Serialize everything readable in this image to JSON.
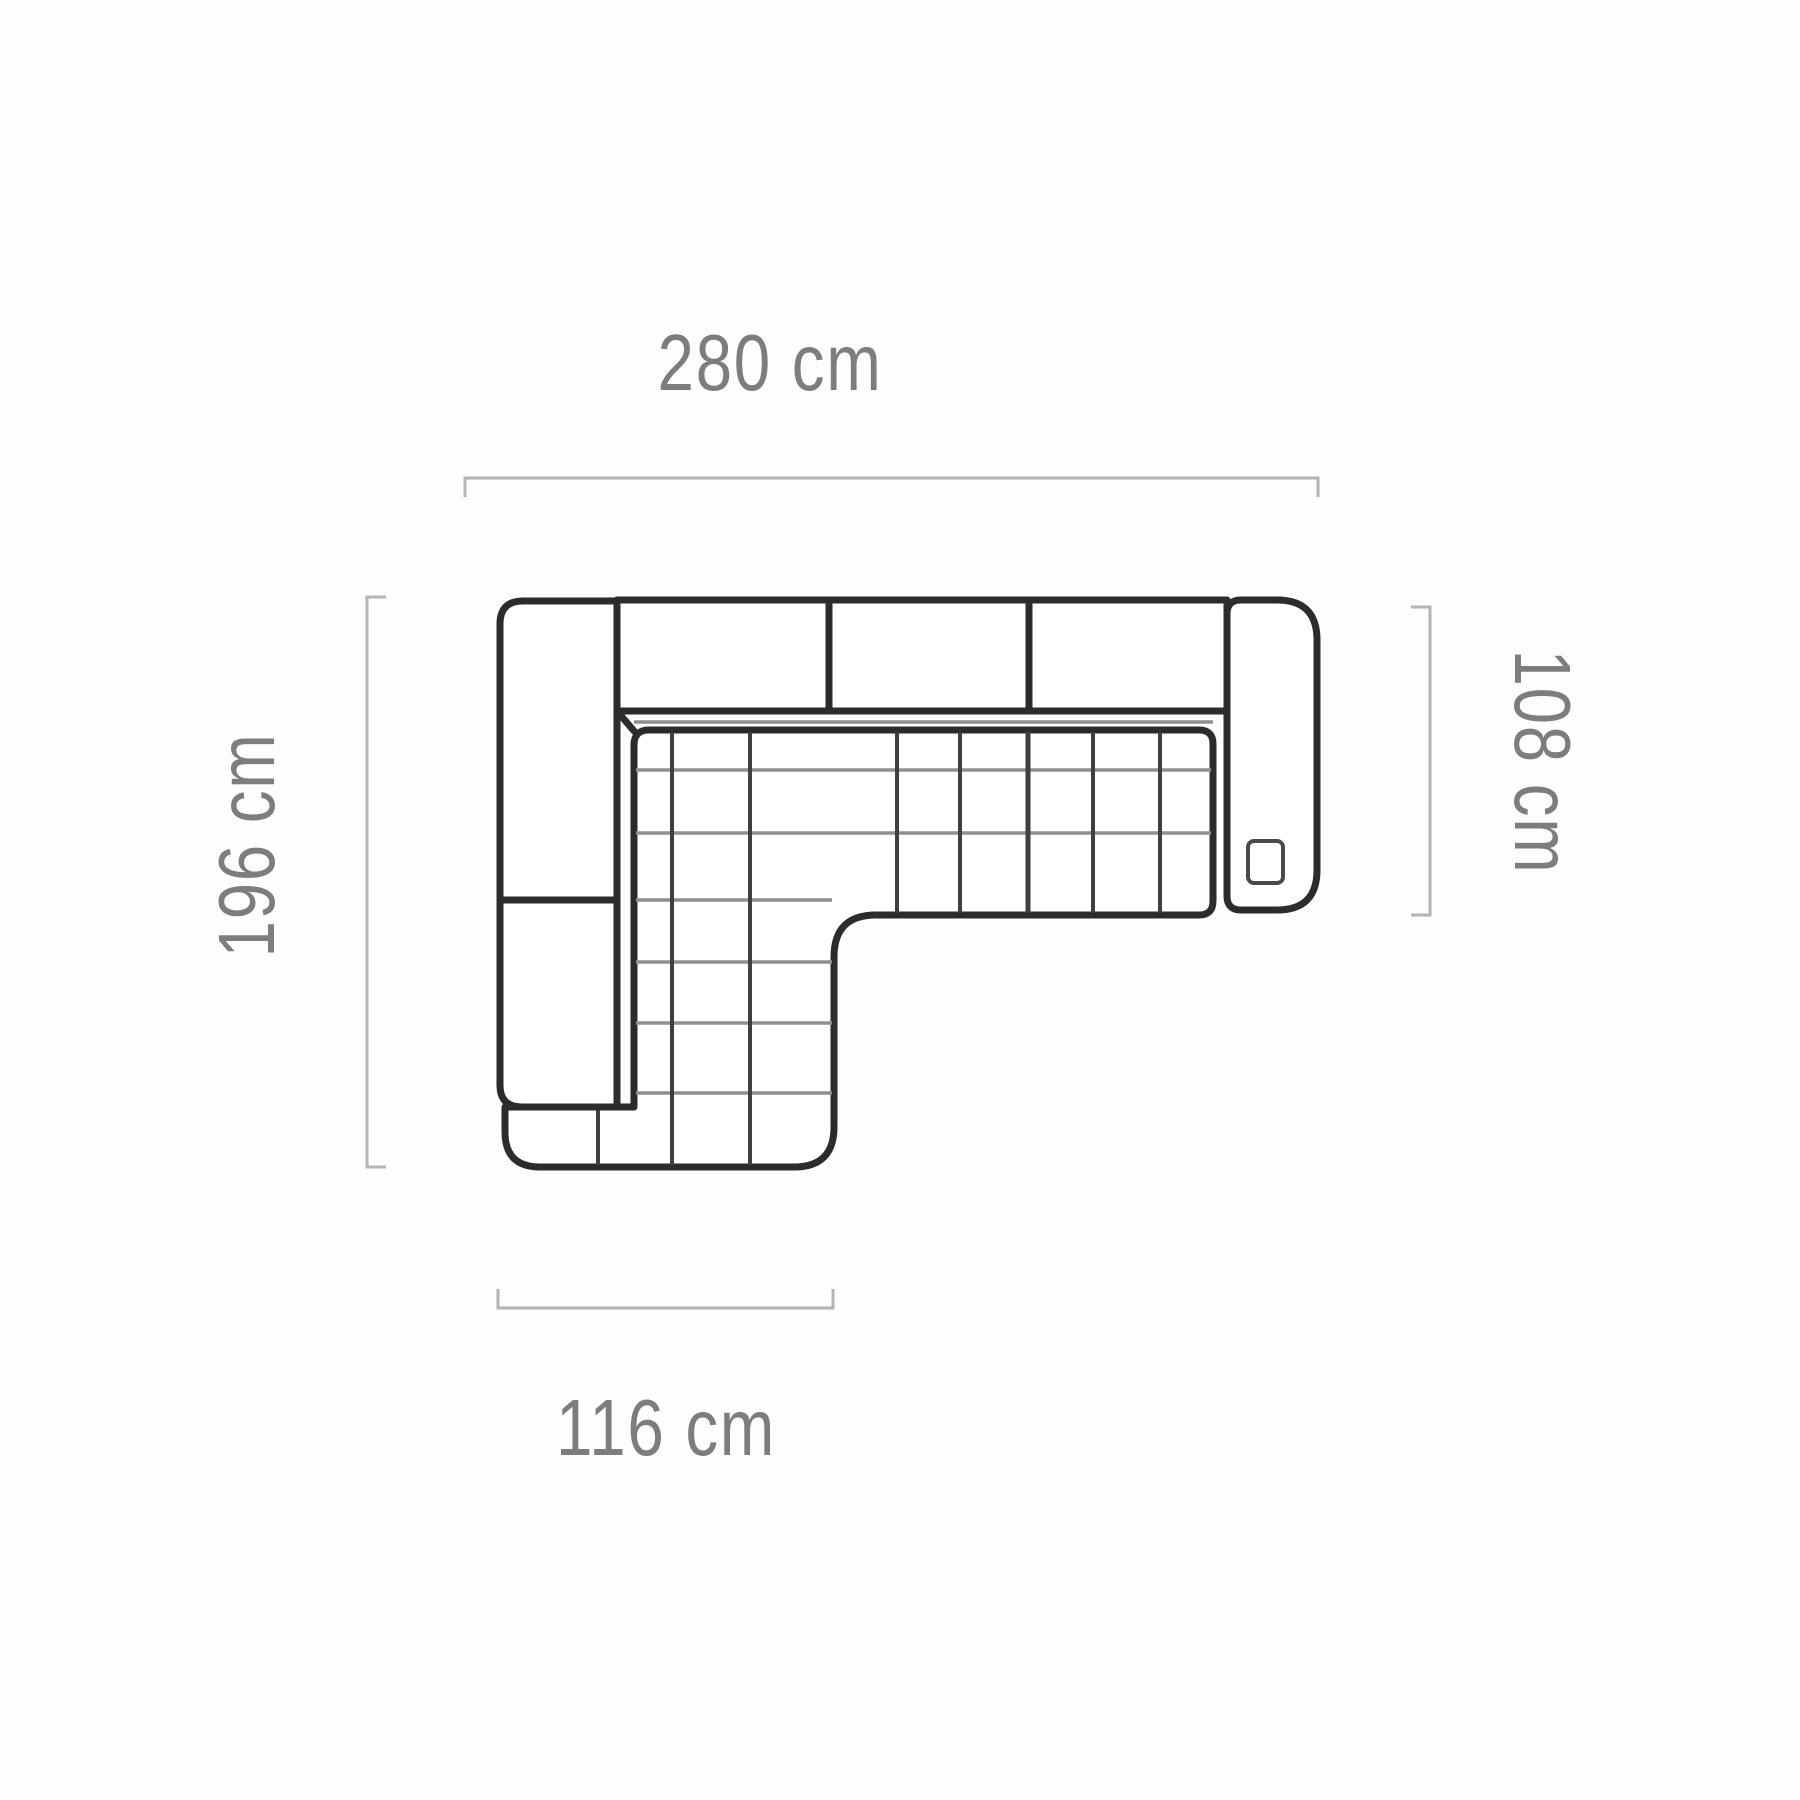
{
  "diagram": {
    "type": "corner-sofa-top-view-dimension-drawing",
    "dimensions": {
      "top": {
        "label": "280 cm",
        "value_cm": 280,
        "side": "top"
      },
      "right": {
        "label": "108 cm",
        "value_cm": 108,
        "side": "right"
      },
      "left": {
        "label": "196 cm",
        "value_cm": 196,
        "side": "left"
      },
      "bottom": {
        "label": "116 cm",
        "value_cm": 116,
        "side": "bottom"
      }
    },
    "colors": {
      "background": "#fdfdfd",
      "outline": "#2c2c2c",
      "quilt_vertical": "#3f3f3f",
      "quilt_horizontal": "#8f8f8f",
      "dimension_line": "#b4b4b4",
      "label_text": "#7d7d7d"
    }
  }
}
